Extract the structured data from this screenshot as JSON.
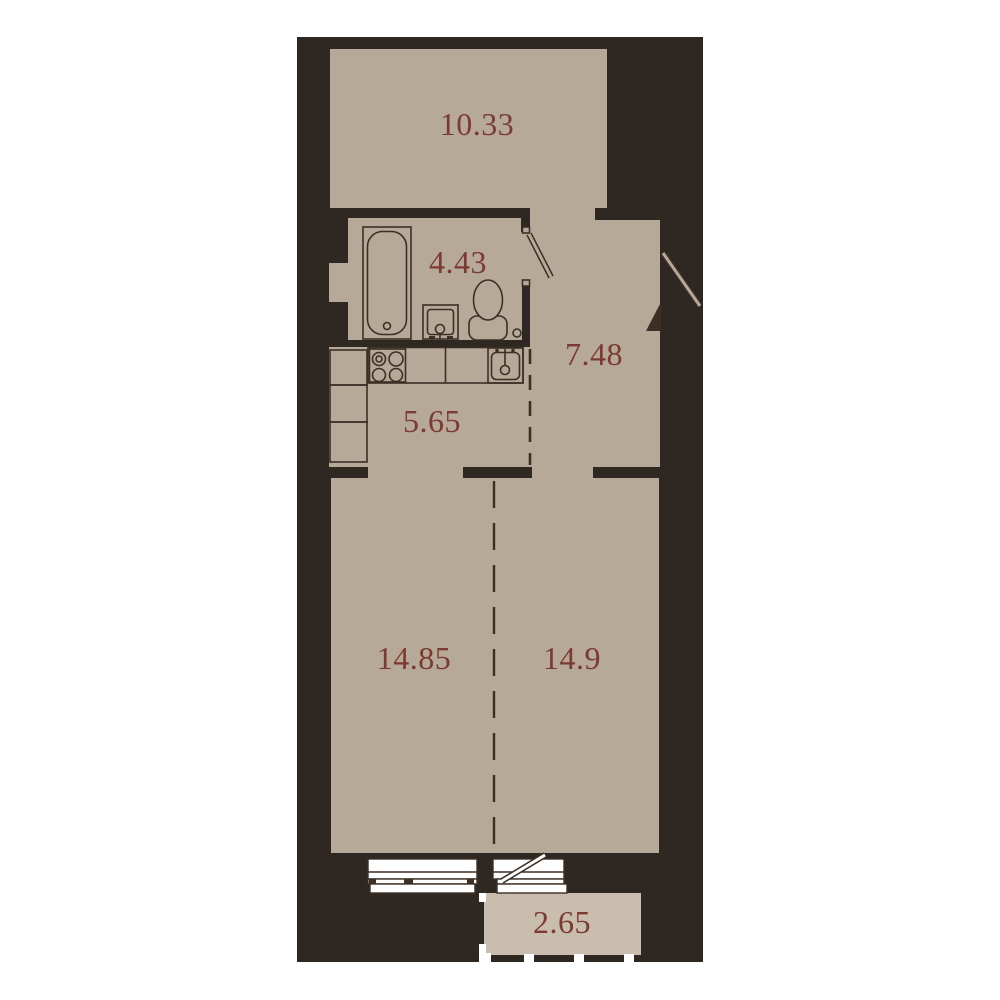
{
  "palette": {
    "page_background": "#ffffff",
    "wall": "#2f2721",
    "floor": "#b6a998",
    "balcony_floor": "#c9bdad",
    "outline": "#3c2f25",
    "label_text": "#7c3a31",
    "window_white": "#ffffff"
  },
  "plan": {
    "rooms": [
      {
        "key": "top-room",
        "area": "10.33"
      },
      {
        "key": "bathroom",
        "area": "4.43"
      },
      {
        "key": "kitchen",
        "area": "5.65"
      },
      {
        "key": "hallway",
        "area": "7.48"
      },
      {
        "key": "living-left",
        "area": "14.85"
      },
      {
        "key": "living-right",
        "area": "14.9"
      },
      {
        "key": "balcony",
        "area": "2.65"
      }
    ],
    "fixtures": [
      "bathtub",
      "washbasin",
      "toilet",
      "stove",
      "kitchen-sink",
      "kitchen-counter",
      "kitchen-cabinets"
    ],
    "doors": [
      "entrance-door",
      "bathroom-door",
      "balcony-door"
    ],
    "windows": [
      "living-room-window",
      "balcony-window"
    ],
    "dividers": [
      "kitchen-hallway-dashed-line",
      "living-rooms-dashed-line"
    ],
    "railing": "balcony-railing"
  }
}
